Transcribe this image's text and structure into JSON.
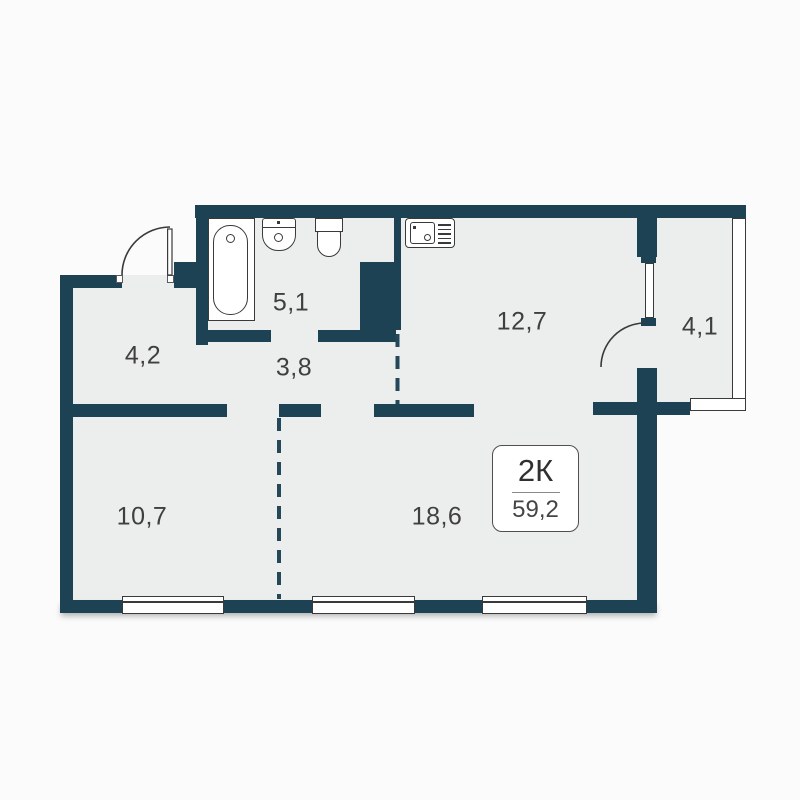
{
  "floor_plan": {
    "apartment": {
      "type_label": "2К",
      "total_area_label": "59,2"
    },
    "rooms": [
      {
        "name": "bathroom",
        "area": "5,1"
      },
      {
        "name": "entry-hall",
        "area": "4,2"
      },
      {
        "name": "corridor",
        "area": "3,8"
      },
      {
        "name": "kitchen",
        "area": "12,7"
      },
      {
        "name": "balcony",
        "area": "4,1"
      },
      {
        "name": "bedroom",
        "area": "10,7"
      },
      {
        "name": "living-room",
        "area": "18,6"
      }
    ],
    "fixtures": [
      "bathtub-icon",
      "washbasin-icon",
      "toilet-icon",
      "kitchen-sink-icon"
    ],
    "features": {
      "doors": 2,
      "windows": 3,
      "dashed_partitions": 2
    },
    "colors": {
      "wall": "#1c4254",
      "floor": "#eceded",
      "background": "#fbfbfb",
      "fixture_line": "#3a3a3a",
      "label_text": "#3f3f3f"
    }
  }
}
